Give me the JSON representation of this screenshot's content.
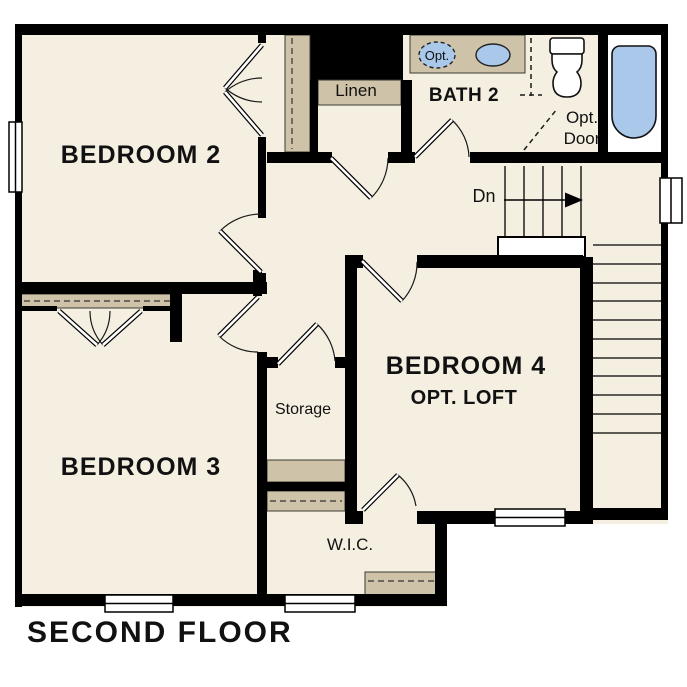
{
  "title": "SECOND FLOOR",
  "colors": {
    "floor": "#F5EFE2",
    "wall": "#000000",
    "shelf": "#CEC3A8",
    "blue": "#A9C8EA",
    "ink": "#1a1a1a",
    "paper": "#FFFFFF"
  },
  "labels": {
    "bedroom2": "BEDROOM 2",
    "bedroom3": "BEDROOM 3",
    "bedroom4": "BEDROOM 4",
    "bedroom4_sub": "OPT. LOFT",
    "bath2": "BATH 2",
    "linen": "Linen",
    "storage": "Storage",
    "wic": "W.I.C.",
    "dn": "Dn",
    "opt_door_line1": "Opt.",
    "opt_door_line2": "Door",
    "opt_sink": "Opt."
  }
}
